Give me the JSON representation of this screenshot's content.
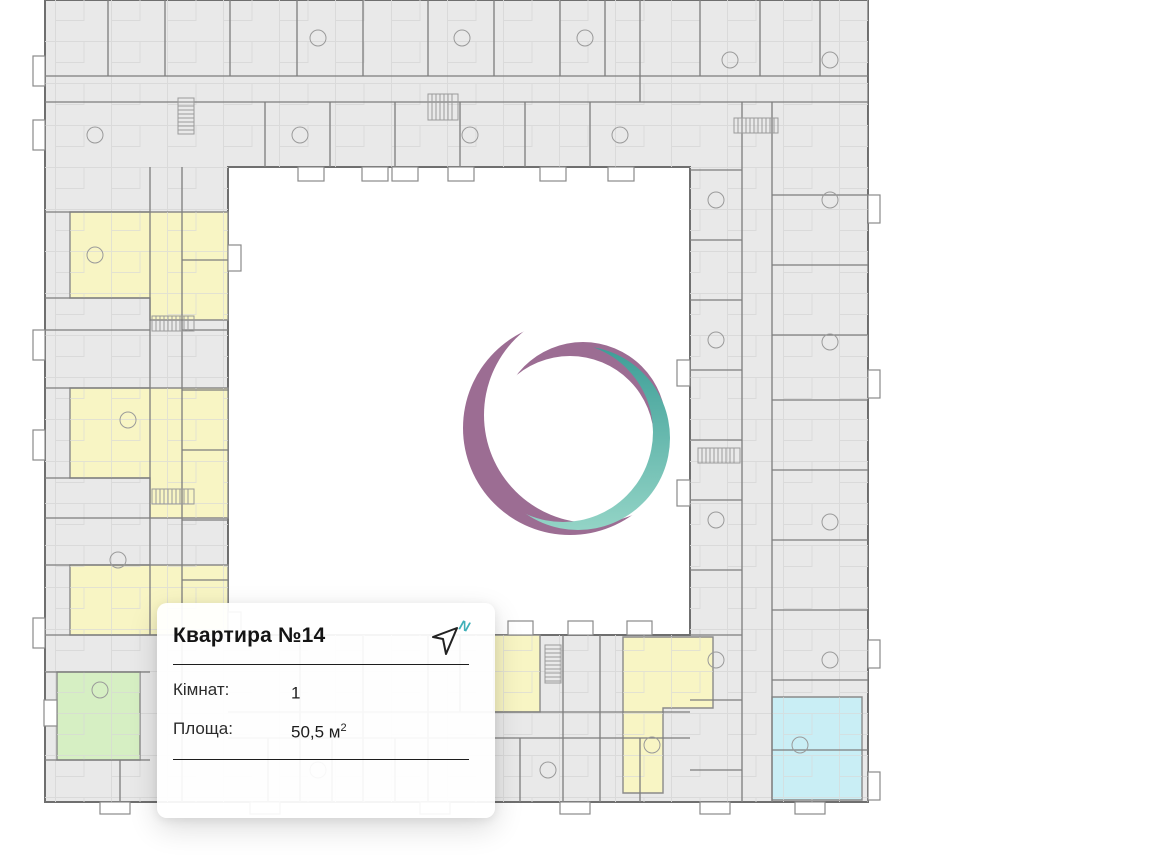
{
  "card": {
    "title": "Квартира №14",
    "fields": [
      {
        "label": "Кімнат:",
        "value": "1",
        "sup": ""
      },
      {
        "label": "Площа:",
        "value": "50,5 м",
        "sup": "2"
      }
    ]
  },
  "north_icon": {
    "letter": "N"
  },
  "colors": {
    "accent_teal": "#3fb0b8",
    "logo_purple": "#9c6d93",
    "logo_teal_start": "#3d9e97",
    "logo_teal_end": "#93d4c6",
    "plan_fill": "#e9e9e9",
    "plan_wall": "#6f6f6f",
    "highlight_yellow": "#f8f5c4",
    "highlight_green": "#d6efc3",
    "highlight_cyan": "#c9eef5"
  }
}
